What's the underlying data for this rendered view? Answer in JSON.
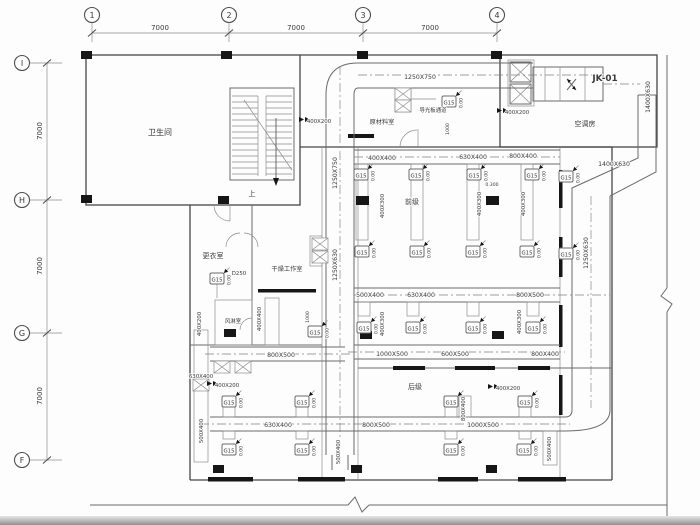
{
  "grid": {
    "cols": [
      "1",
      "2",
      "3",
      "4"
    ],
    "rows": [
      "I",
      "H",
      "G",
      "F"
    ],
    "col_dims": [
      "7000",
      "7000",
      "7000"
    ],
    "row_dims": [
      "7000",
      "7000",
      "7000"
    ]
  },
  "rooms": {
    "bathroom": "卫生间",
    "stair_up": "上",
    "ahu_unit": "JK-01",
    "ahu_room": "空调房",
    "raw_material": "原材料室",
    "light_guide": "导光板通道",
    "changing": "更衣室",
    "drying": "干燥工作室",
    "air_shower": "风淋室",
    "front_stage": "前级",
    "rear_stage": "后级"
  },
  "ducts": {
    "d1250x750": "1250X750",
    "d1250x630": "1250X630",
    "d1400x630": "1400X630",
    "d1000x500": "1000X500",
    "d800x500": "800X500",
    "d800x400": "800X400",
    "d630x400": "630X400",
    "d600x500": "600X500",
    "d500x400": "500X400",
    "d400x400": "400X400",
    "d400x300": "400X300",
    "d400x200": "400X200",
    "d250": "D250",
    "drop": "1000",
    "elev300": "0.300"
  },
  "diffuser": {
    "tag": "G15",
    "elev": "0.00"
  }
}
